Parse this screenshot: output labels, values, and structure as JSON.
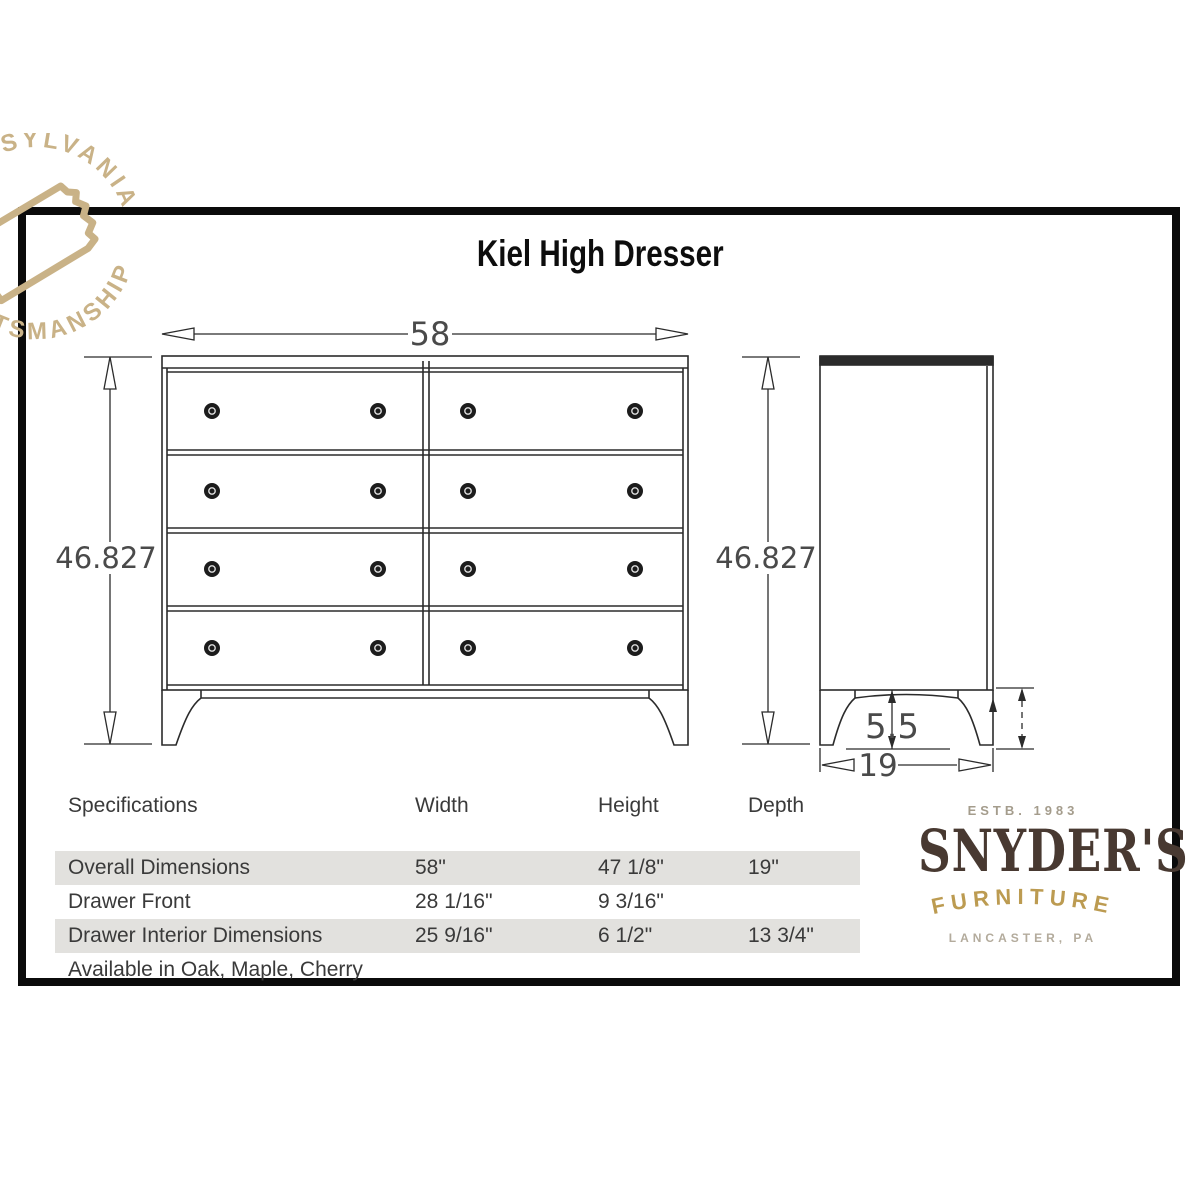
{
  "title": "Kiel High Dresser",
  "watermark": {
    "arc_top": "PENNSYLVANIA",
    "arc_bottom": "CRAFTSMANSHIP",
    "icon": "pennsylvania-state-outline",
    "color": "#c9b287"
  },
  "drawings": {
    "front_view": {
      "label": "front-view",
      "width_dim": "58",
      "height_dim": "46.827",
      "drawer_rows": 4,
      "drawer_columns": 2,
      "knobs_per_drawer": 2
    },
    "side_view": {
      "label": "side-view",
      "height_dim": "46.827",
      "depth_dim": "19",
      "leg_height_dim": "5.5"
    }
  },
  "spec_table": {
    "columns": [
      "Specifications",
      "Width",
      "Height",
      "Depth"
    ],
    "rows": [
      {
        "label": "Overall Dimensions",
        "width": "58\"",
        "height": "47 1/8\"",
        "depth": "19\""
      },
      {
        "label": "Drawer Front",
        "width": "28 1/16\"",
        "height": "9 3/16\"",
        "depth": ""
      },
      {
        "label": "Drawer Interior Dimensions",
        "width": "25 9/16\"",
        "height": "6 1/2\"",
        "depth": "13 3/4\""
      }
    ],
    "footnote": "Available in Oak, Maple, Cherry",
    "shade_color": "#e2e1de"
  },
  "logo": {
    "estb": "ESTB. 1983",
    "name": "SNYDER'S",
    "type": "FURNITURE",
    "location": "LANCASTER, PA",
    "brand_color": "#483931",
    "gold_color": "#bc9b51"
  },
  "colors": {
    "line": "#2b2b2b",
    "dim_text": "#4a4a4a",
    "frame": "#0b0b0b"
  }
}
